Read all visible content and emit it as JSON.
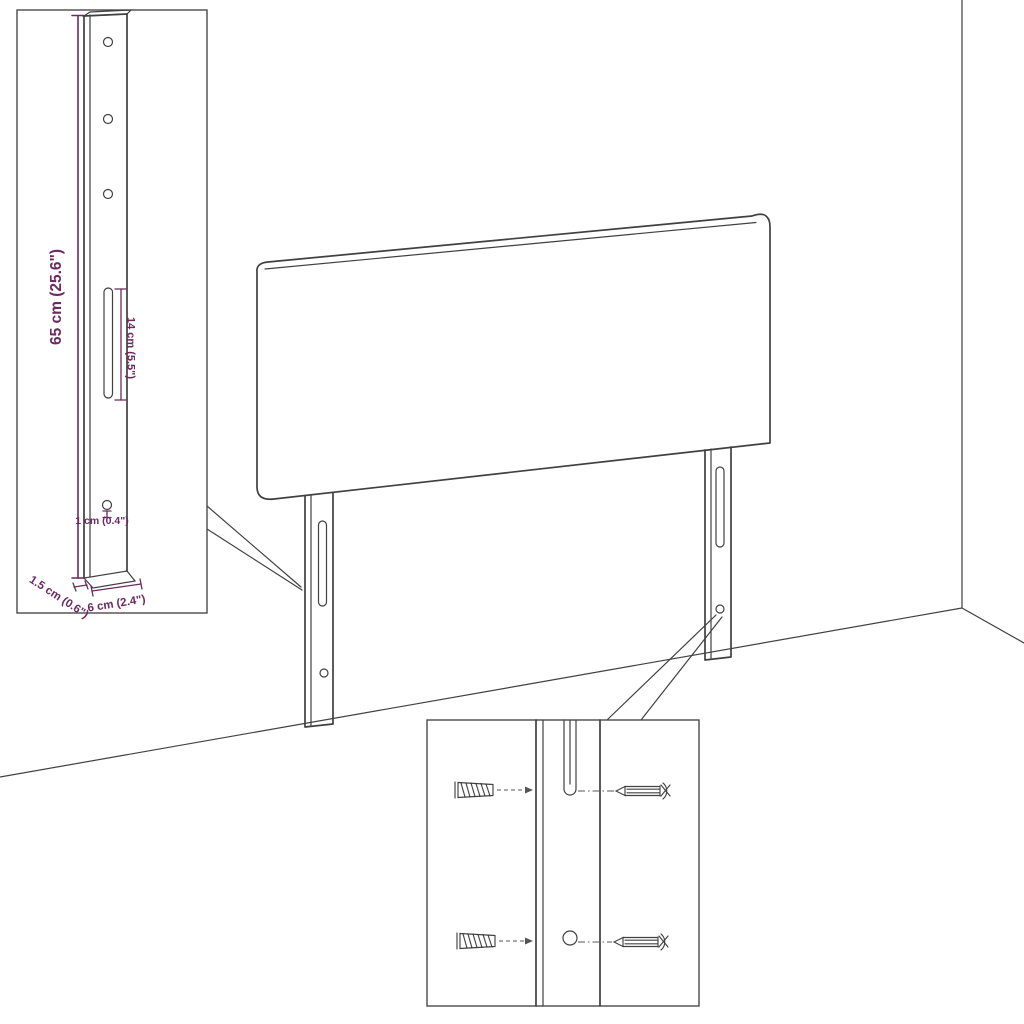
{
  "colors": {
    "dimension": "#6b2a60",
    "line": "#404040",
    "background": "#ffffff"
  },
  "dimensions": {
    "bracket_height": "65 cm (25.6\")",
    "slot_length": "14 cm (5.5\")",
    "hole_size": "1 cm (0.4\")",
    "bracket_depth": "1.5 cm (0.6\")",
    "bracket_width": "6 cm (2.4\")"
  }
}
